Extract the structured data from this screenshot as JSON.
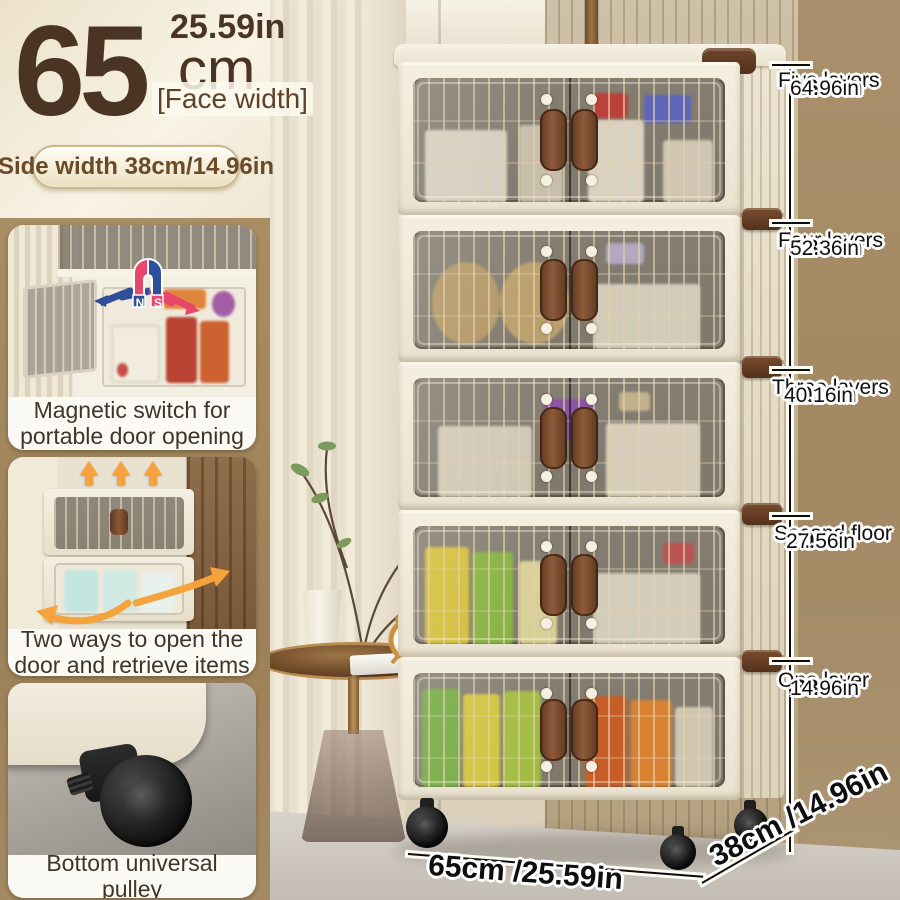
{
  "header": {
    "face_width_value": "65",
    "face_width_unit": "cm",
    "face_width_inches": "25.59in",
    "face_width_label": "[Face width]",
    "side_width_pill": "Side width 38cm/14.96in"
  },
  "features": [
    {
      "caption": "Magnetic switch for portable door opening",
      "magnet_n": "N",
      "magnet_s": "S"
    },
    {
      "caption": "Two ways to open the door and retrieve items"
    },
    {
      "caption": "Bottom universal pulley"
    }
  ],
  "height_markers": [
    {
      "name": "Five layers",
      "cm": "165cm",
      "inches": "64.96in"
    },
    {
      "name": "Four layers",
      "cm": "133cm",
      "inches": "52.36in"
    },
    {
      "name": "Three layers",
      "cm": "102cm",
      "inches": "40.16in"
    },
    {
      "name": "Second floor",
      "cm": "70cm",
      "inches": "27.56in"
    },
    {
      "name": "One layer",
      "cm": "38cm",
      "inches": "14.96in"
    }
  ],
  "floor_dimensions": {
    "width": "65cm /25.59in",
    "depth": "38cm /14.96in"
  },
  "colors": {
    "brand_brown": "#4a3423",
    "panel_tan": "#a0845c",
    "cabinet_cream": "#f1ebdc",
    "handle_brown": "#7c4f33",
    "magnet_red": "#e8476b",
    "magnet_blue": "#2f4f9d",
    "arrow_orange": "#f5a33c",
    "marker_text": "#111111"
  }
}
